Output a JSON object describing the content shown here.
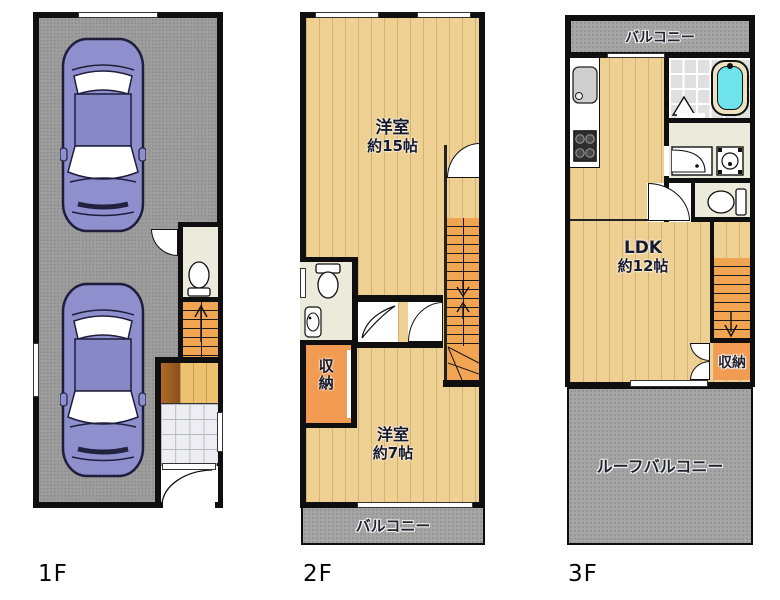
{
  "floor_labels": {
    "f1": "1F",
    "f2": "2F",
    "f3": "3F"
  },
  "f2": {
    "room_main": {
      "l1": "洋室",
      "l2": "約15帖"
    },
    "room_sub": {
      "l1": "洋室",
      "l2": "約7帖"
    },
    "storage": "収納",
    "balcony": "バルコニー"
  },
  "f3": {
    "ldk": {
      "l1": "LDK",
      "l2": "約12帖"
    },
    "storage": "収納",
    "balcony": "バルコニー",
    "roof_balcony": "ルーフバルコニー"
  },
  "colors": {
    "wall": "#0f0f0f",
    "wood_floor": "#edd092",
    "garage_floor": "#9d9d9d",
    "balcony_floor": "#a5a5a5",
    "stairs": "#f1a452",
    "storage": "#f29b52",
    "utility_room": "#eceadb",
    "bathtub_water": "#6fe3ec",
    "car_body": "#8e8fcc",
    "genkan_tile": "#ededf2"
  }
}
